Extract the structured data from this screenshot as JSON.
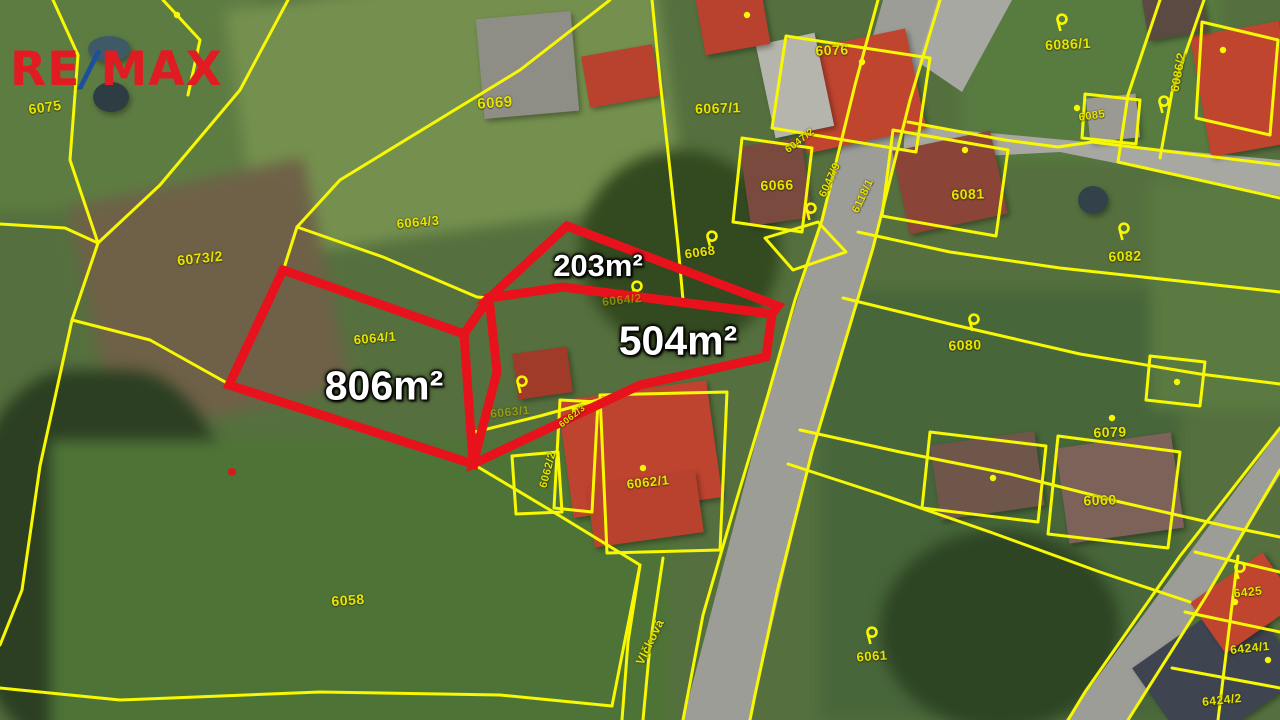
{
  "logo": {
    "re": "RE",
    "slash": "/",
    "max": "MAX",
    "red": "#e11b22",
    "blue": "#1d4fa1"
  },
  "map": {
    "type": "cadastral-aerial-map",
    "highlight_color": "#e8121c",
    "boundary_color": "#f8f800",
    "label_color": "#e8e400",
    "area_labels": [
      {
        "text": "203m²",
        "x": 598,
        "y": 266,
        "size": 31
      },
      {
        "text": "504m²",
        "x": 678,
        "y": 341,
        "size": 41
      },
      {
        "text": "806m²",
        "x": 384,
        "y": 386,
        "size": 41
      }
    ],
    "parcel_labels": [
      {
        "text": "6075",
        "x": 45,
        "y": 107,
        "rot": -8,
        "size": 14
      },
      {
        "text": "6069",
        "x": 495,
        "y": 103,
        "rot": -4,
        "size": 15
      },
      {
        "text": "6073/2",
        "x": 200,
        "y": 258,
        "rot": -6,
        "size": 14
      },
      {
        "text": "6064/3",
        "x": 418,
        "y": 222,
        "rot": -5,
        "size": 13
      },
      {
        "text": "6064/1",
        "x": 375,
        "y": 338,
        "rot": -5,
        "size": 13
      },
      {
        "text": "6064/2",
        "x": 622,
        "y": 300,
        "rot": -6,
        "size": 12,
        "dim": true
      },
      {
        "text": "6063/1",
        "x": 510,
        "y": 412,
        "rot": -6,
        "size": 12,
        "dim": true
      },
      {
        "text": "6058",
        "x": 348,
        "y": 600,
        "rot": -4,
        "size": 14
      },
      {
        "text": "6068",
        "x": 700,
        "y": 252,
        "rot": -8,
        "size": 13
      },
      {
        "text": "6067/1",
        "x": 718,
        "y": 108,
        "rot": -2,
        "size": 14
      },
      {
        "text": "6076",
        "x": 832,
        "y": 50,
        "rot": -2,
        "size": 14
      },
      {
        "text": "6066",
        "x": 777,
        "y": 185,
        "rot": -2,
        "size": 14
      },
      {
        "text": "6047/2",
        "x": 800,
        "y": 141,
        "rot": -38,
        "size": 10
      },
      {
        "text": "6047/9",
        "x": 830,
        "y": 180,
        "rot": -65,
        "size": 11
      },
      {
        "text": "6118/1",
        "x": 863,
        "y": 196,
        "rot": -65,
        "size": 11
      },
      {
        "text": "6086/1",
        "x": 1068,
        "y": 44,
        "rot": -3,
        "size": 14
      },
      {
        "text": "6085",
        "x": 1092,
        "y": 116,
        "rot": -8,
        "size": 11
      },
      {
        "text": "6086/2",
        "x": 1178,
        "y": 72,
        "rot": -80,
        "size": 12
      },
      {
        "text": "6081",
        "x": 968,
        "y": 194,
        "rot": -2,
        "size": 14
      },
      {
        "text": "6082",
        "x": 1125,
        "y": 256,
        "rot": -2,
        "size": 14
      },
      {
        "text": "6080",
        "x": 965,
        "y": 345,
        "rot": -2,
        "size": 14
      },
      {
        "text": "6079",
        "x": 1110,
        "y": 432,
        "rot": -2,
        "size": 14
      },
      {
        "text": "6060",
        "x": 1100,
        "y": 500,
        "rot": -2,
        "size": 14
      },
      {
        "text": "6061",
        "x": 872,
        "y": 656,
        "rot": -4,
        "size": 13
      },
      {
        "text": "6425",
        "x": 1248,
        "y": 592,
        "rot": -6,
        "size": 12
      },
      {
        "text": "6424/1",
        "x": 1250,
        "y": 648,
        "rot": -6,
        "size": 12
      },
      {
        "text": "6424/2",
        "x": 1222,
        "y": 700,
        "rot": -6,
        "size": 12
      },
      {
        "text": "6062/1",
        "x": 648,
        "y": 482,
        "rot": -6,
        "size": 13
      },
      {
        "text": "6062/2",
        "x": 548,
        "y": 470,
        "rot": -75,
        "size": 11
      },
      {
        "text": "6062/3",
        "x": 572,
        "y": 416,
        "rot": -38,
        "size": 9
      }
    ],
    "street_label": {
      "text": "Vlčková",
      "x": 650,
      "y": 642,
      "rot": -64,
      "size": 12
    },
    "parcel_markers": [
      [
        1063,
        23
      ],
      [
        812,
        212
      ],
      [
        713,
        240
      ],
      [
        638,
        290
      ],
      [
        975,
        323
      ],
      [
        1125,
        232
      ],
      [
        1165,
        105
      ],
      [
        873,
        636
      ],
      [
        1241,
        571
      ],
      [
        523,
        385
      ]
    ],
    "building_dots": [
      [
        862,
        62
      ],
      [
        965,
        150
      ],
      [
        575,
        410
      ],
      [
        643,
        468
      ],
      [
        1112,
        418
      ],
      [
        993,
        478
      ],
      [
        1077,
        108
      ],
      [
        1223,
        50
      ],
      [
        1177,
        382
      ],
      [
        1235,
        602
      ],
      [
        1268,
        660
      ],
      [
        177,
        15
      ],
      [
        747,
        15
      ]
    ],
    "survey_dot": {
      "x": 232,
      "y": 472,
      "color": "#d61a1a"
    }
  }
}
